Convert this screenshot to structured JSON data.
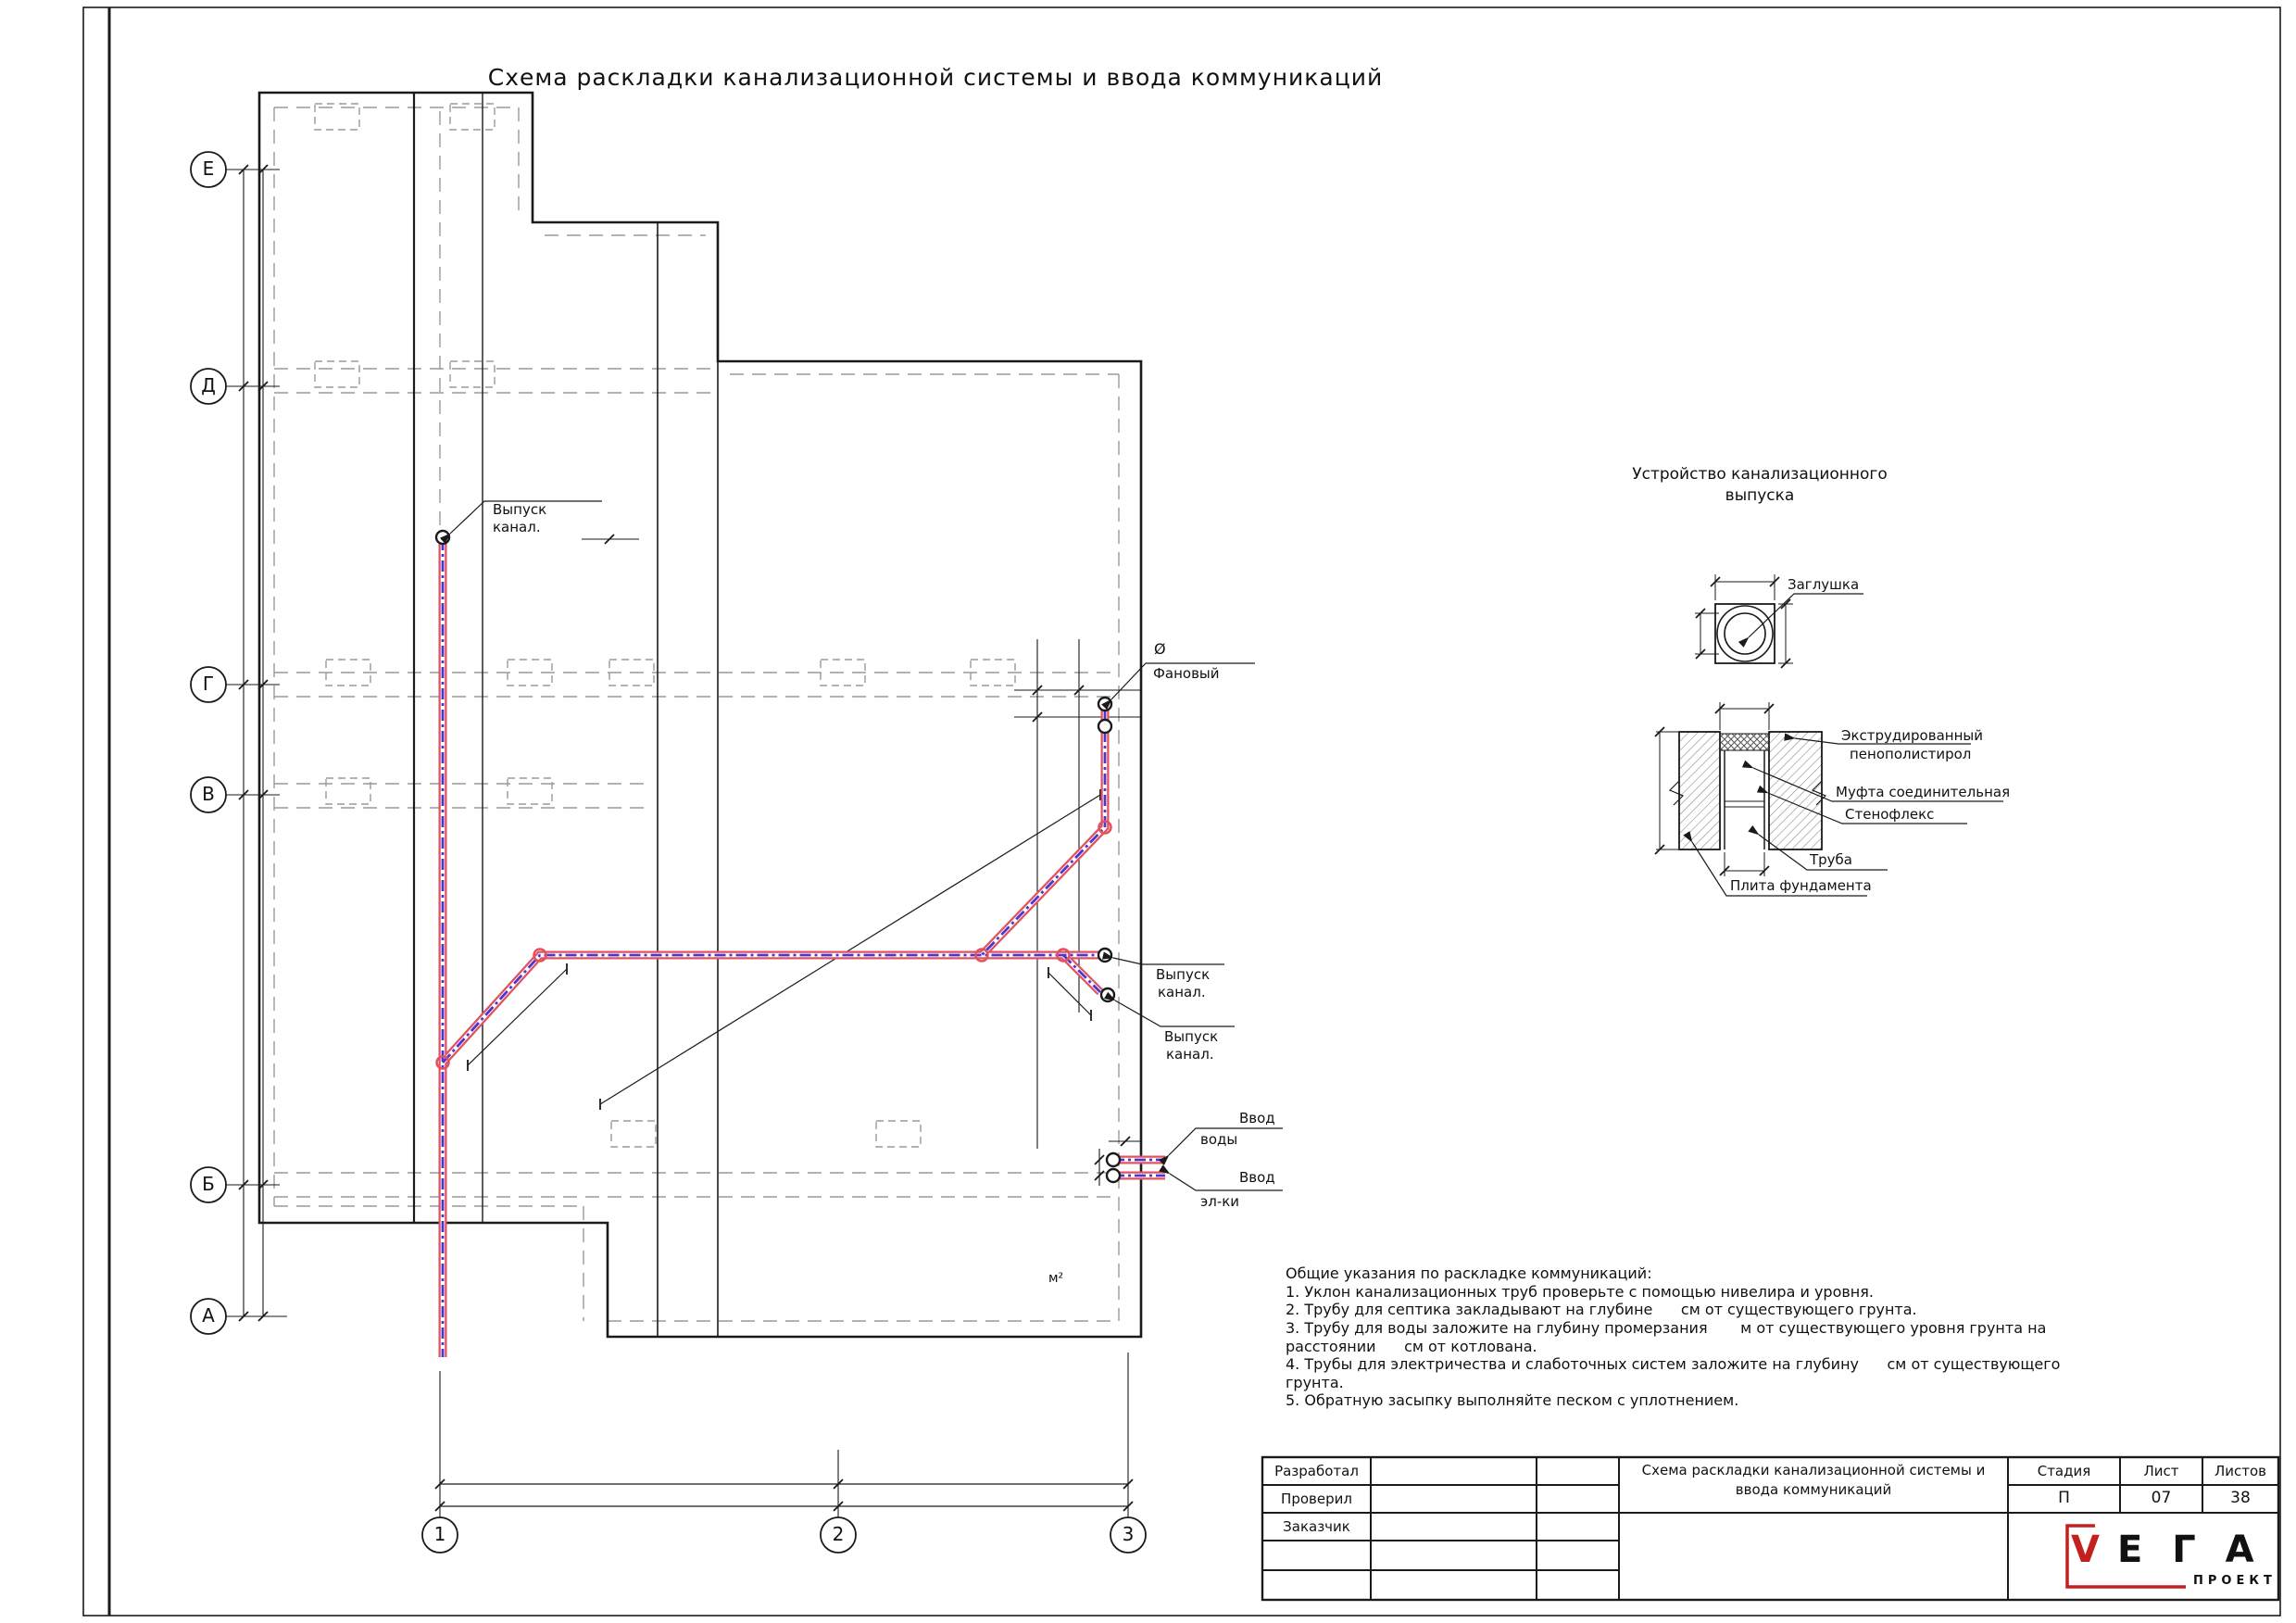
{
  "page": {
    "title": "Схема раскладки канализационной системы и ввода коммуникаций"
  },
  "colors": {
    "pipe_red": "#e0525f",
    "pipe_blue": "#4d35cf",
    "logo_red": "#c42020",
    "dashed_gray": "#9a9a9a",
    "line_black": "#1a1a1a"
  },
  "axes": {
    "letters": [
      "Е",
      "Д",
      "Г",
      "В",
      "Б",
      "А"
    ],
    "numbers": [
      "1",
      "2",
      "3"
    ]
  },
  "plan": {
    "labels": {
      "outlet_top": {
        "line1": "Выпуск",
        "line2": "канал."
      },
      "vent": {
        "dia": "Ø",
        "name": "Фановый"
      },
      "outlet_right_1": {
        "line1": "Выпуск",
        "line2": "канал."
      },
      "outlet_right_2": {
        "line1": "Выпуск",
        "line2": "канал."
      },
      "water_inlet": {
        "line1": "Ввод",
        "line2": "воды"
      },
      "electric_inlet": {
        "line1": "Ввод",
        "line2": "эл-ки"
      },
      "area_unit": "м²"
    }
  },
  "detail": {
    "title_line1": "Устройство канализационного",
    "title_line2": "выпуска",
    "plug_label": "Заглушка",
    "labels": {
      "xps_line1": "Экструдированный",
      "xps_line2": "пенополистирол",
      "coupling": "Муфта соединительная",
      "stenoflex": "Стенофлекс",
      "pipe": "Труба",
      "slab": "Плита фундамента"
    }
  },
  "notes": {
    "lines": [
      "Общие указания по раскладке коммуникаций:",
      "1. Уклон канализационных труб проверьте с помощью нивелира и уровня.",
      "2. Трубу для септика закладывают на глубине      см от существующего грунта.",
      "3. Трубу для воды заложите на глубину промерзания       м от существующего уровня грунта на",
      "расстоянии      см от котлована.",
      "4. Трубы для электричества и слаботочных систем заложите на глубину      см от существующего",
      "грунта.",
      "5. Обратную засыпку выполняйте песком с уплотнением."
    ]
  },
  "title_block": {
    "developed_label": "Разработал",
    "checked_label": "Проверил",
    "customer_label": "Заказчик",
    "doc_title_line1": "Схема раскладки канализационной системы и",
    "doc_title_line2": "ввода коммуникаций",
    "stage_label": "Стадия",
    "sheet_label": "Лист",
    "sheets_label": "Листов",
    "stage_value": "П",
    "sheet_value": "07",
    "sheets_value": "38",
    "logo": {
      "v": "V",
      "rest": "Е Г А",
      "subtitle": "ПРОЕКТ"
    }
  }
}
